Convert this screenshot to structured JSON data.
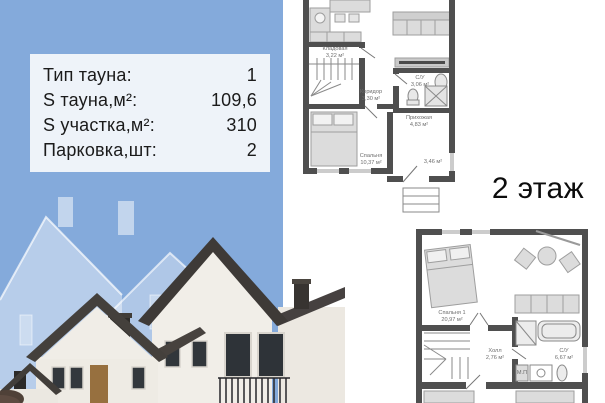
{
  "info_panel": {
    "rows": [
      {
        "label": "Тип тауна:",
        "value": "1"
      },
      {
        "label": "S тауна,м²:",
        "value": "109,6"
      },
      {
        "label": "S участка,м²:",
        "value": "310"
      },
      {
        "label": "Парковка,шт:",
        "value": "2"
      }
    ]
  },
  "floor2_heading": "2 этаж",
  "plan_floor1": {
    "rooms": [
      {
        "name": "Кладовая",
        "area": "3,22 м²"
      },
      {
        "name": "Коридор",
        "area": "3,30 м²"
      },
      {
        "name": "С/У",
        "area": "3,06 м²"
      },
      {
        "name": "Прихожая",
        "area": "4,83 м²"
      },
      {
        "name": "Спальня",
        "area": "10,37 м²"
      },
      {
        "name": "",
        "area": "3,46 м²"
      }
    ]
  },
  "plan_floor2": {
    "rooms": [
      {
        "name": "Спальня 1",
        "area": "20,97 м²"
      },
      {
        "name": "Холл",
        "area": "2,76 м²"
      },
      {
        "name": "С/У",
        "area": "6,67 м²"
      },
      {
        "name": "М.П",
        "area": ""
      }
    ]
  },
  "colors": {
    "panel_blue": "#84aadb",
    "table_bg": "#f2f6fa",
    "text_dark": "#1b1b1b",
    "plan_wall": "#4f4f4f",
    "furniture_gray": "#dcdcdc",
    "label_gray": "#6e6e6e",
    "roof_dark": "#3e3a37",
    "house_wall": "#f1eee8"
  }
}
